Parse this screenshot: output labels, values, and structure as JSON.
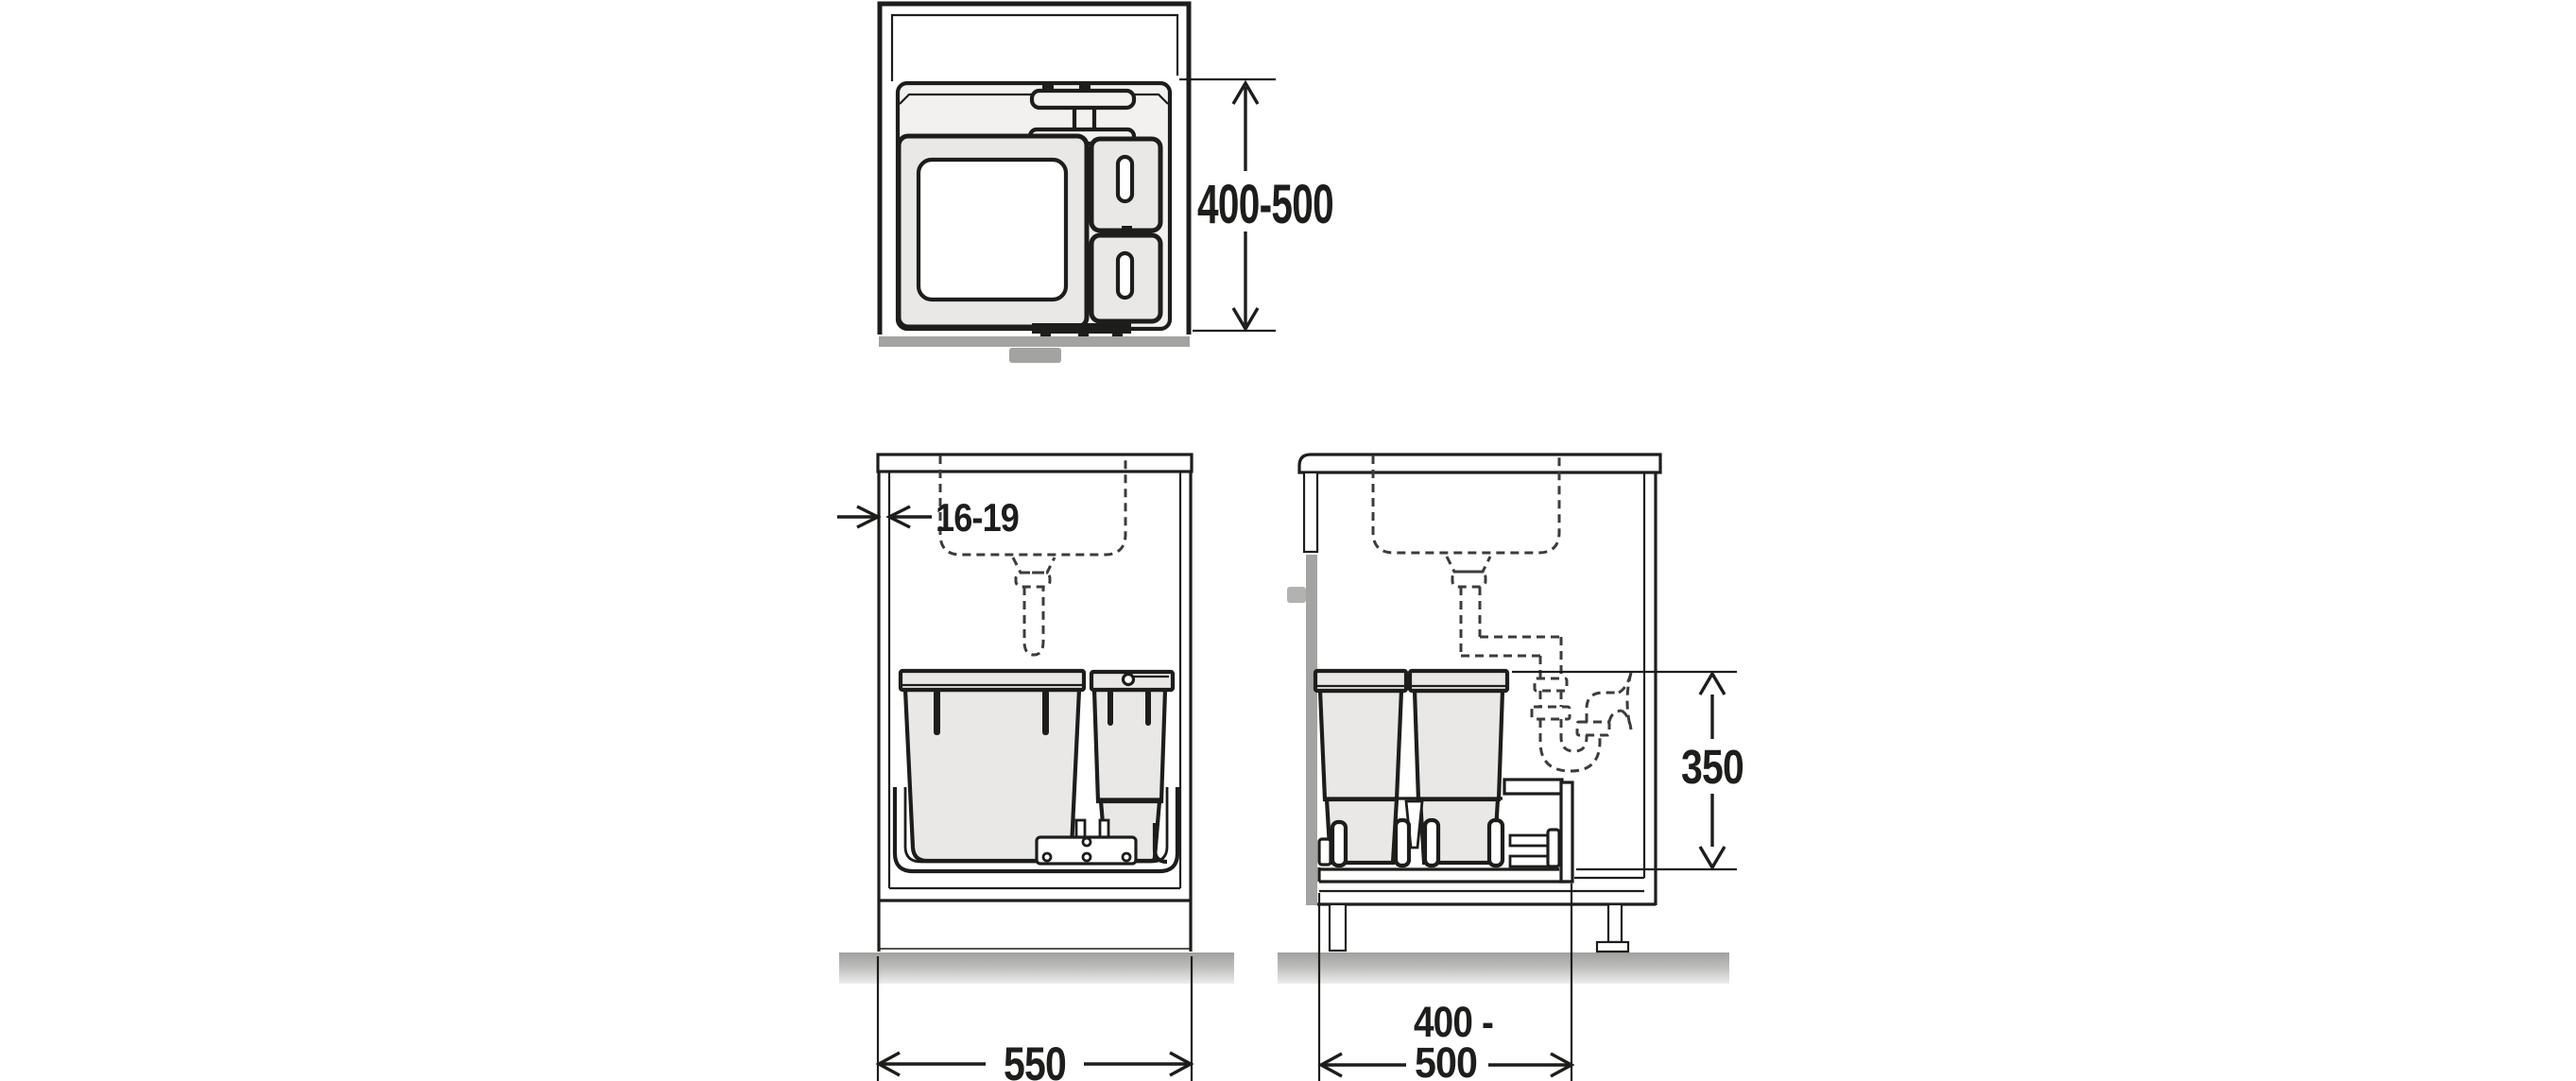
{
  "drawing": {
    "type": "cabinet-waste-bin-installation-diagram",
    "palette": {
      "line": "#1d1d1b",
      "dashed_line": "#3c3c3c",
      "bin_fill": "#e9e8e6",
      "panel_fill": "#f2f1ef",
      "door_gray": "#a3a3a1",
      "handle_gray": "#b2b2b0",
      "floor_gray": "#a6a6a4",
      "text": "#1d1d1b"
    },
    "dimensions": {
      "plan_depth": "400-500",
      "front_panel_thickness": "16-19",
      "front_width": "550",
      "side_height": "350",
      "side_depth_line1": "400 -",
      "side_depth_line2": "500"
    }
  }
}
